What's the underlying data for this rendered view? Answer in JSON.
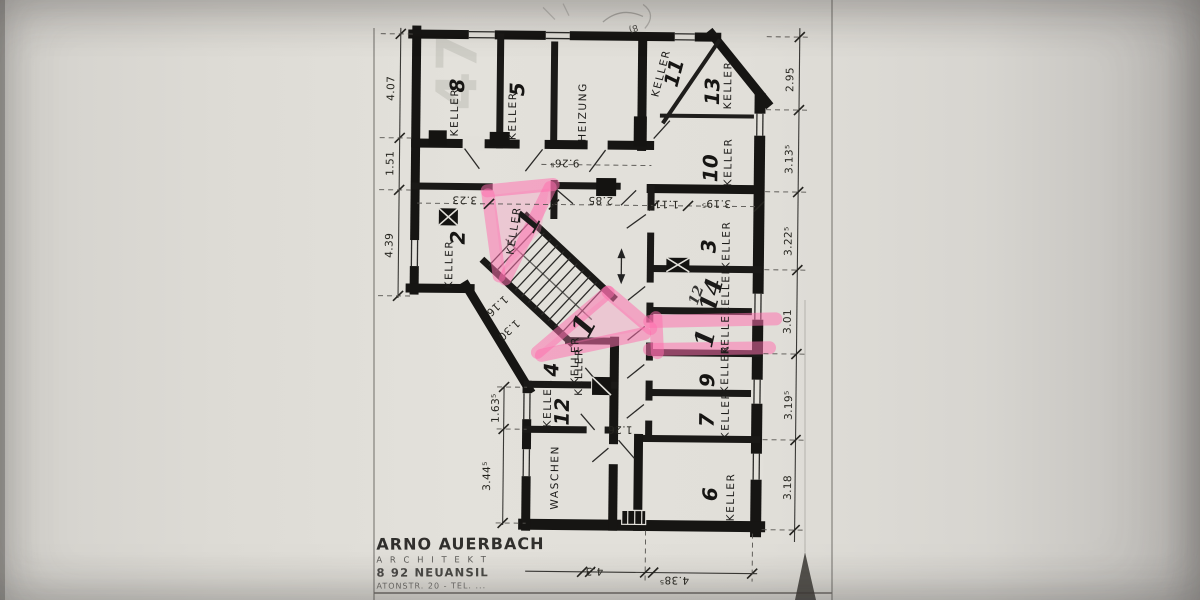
{
  "rooms": {
    "k8": {
      "label": "KELLER",
      "number": "8"
    },
    "k5": {
      "label": "KELLER",
      "number": "5"
    },
    "heizung": {
      "label": "HEIZUNG"
    },
    "k11": {
      "label": "KELLER",
      "number": "11"
    },
    "k13": {
      "label": "KELLER",
      "number": "13"
    },
    "k10": {
      "label": "KELLER",
      "number": "10"
    },
    "k3": {
      "label": "KELLER",
      "number": "3"
    },
    "k14": {
      "label": "KELLER"
    },
    "k1_right": {
      "label": "KELLER"
    },
    "k9": {
      "label": "KELLER",
      "number": "9"
    },
    "k7": {
      "label": "KELLER",
      "number": "7"
    },
    "k6": {
      "label": "KELLER",
      "number": "6"
    },
    "k2": {
      "label": "KELLER",
      "number": "2"
    },
    "k1_upper": {
      "label": "KELLER"
    },
    "k1_lower": {
      "label": "KELLER"
    },
    "k4": {
      "label": "KELLER",
      "number": "4"
    },
    "k12": {
      "label": "KELLER",
      "number": "12"
    },
    "waschen": {
      "label": "WASCHEN"
    }
  },
  "dims": {
    "left": {
      "d1": "4.07",
      "d2": "1.51",
      "d3": "4.39"
    },
    "left_inner": {
      "d1": "1.63⁵",
      "d2": "3.44⁵"
    },
    "right": {
      "d1": "2.95",
      "d2": "3.13⁵",
      "d3": "3.22⁵",
      "d4": "3.01",
      "d5": "3.19⁵",
      "d6": "3.18"
    },
    "bottom": {
      "d1": "4.3",
      "d2": "4.38⁵"
    },
    "inner": {
      "d9265": "9.26⁵",
      "d323": "3.23",
      "d285": "2.85",
      "d1115": "1.11⁵",
      "d3195": "3.19⁵",
      "d126": "1.26",
      "d116": "1.16",
      "d130": "1.30"
    }
  },
  "annotations": {
    "hand_one_upper": "1",
    "hand_one_lower": "1",
    "hand_one_right": "1",
    "hand_old_number": "12",
    "hand_new_number": "14",
    "faint_numeral": "47",
    "tiny_note": "8)"
  },
  "stamp": {
    "line1": "ARNO AUERBACH",
    "line2": "A R C H I T E K T",
    "line3": "8 92 NEUANSIL",
    "line4": "ATONSTR. 20 - TEL. ..."
  }
}
